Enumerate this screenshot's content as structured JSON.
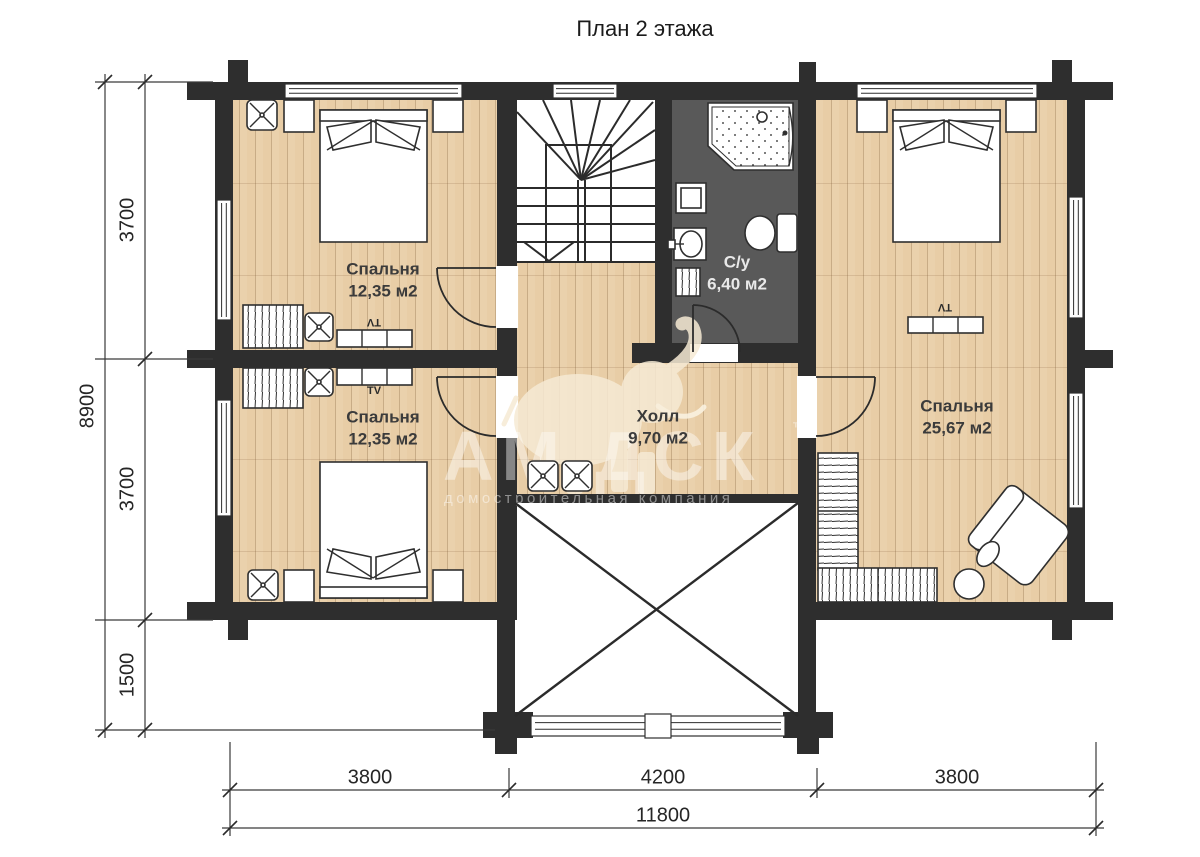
{
  "title": "План 2 этажа",
  "rooms": {
    "bedroom_top_left": {
      "name": "Спальня",
      "area": "12,35 м2"
    },
    "bedroom_bottom_left": {
      "name": "Спальня",
      "area": "12,35 м2"
    },
    "bathroom": {
      "name": "С/у",
      "area": "6,40 м2"
    },
    "hall": {
      "name": "Холл",
      "area": "9,70 м2"
    },
    "bedroom_right": {
      "name": "Спальня",
      "area": "25,67 м2"
    }
  },
  "dimensions": {
    "left": {
      "total": "8900",
      "segments": [
        "3700",
        "3700",
        "1500"
      ]
    },
    "bottom": {
      "total": "11800",
      "segments": [
        "3800",
        "4200",
        "3800"
      ]
    }
  },
  "labels": {
    "tv": "TV"
  },
  "watermark": {
    "text": "АМ ДСК",
    "tm": "™",
    "subtitle": "домостроительная компания"
  },
  "colors": {
    "wall": "#2e2e2e",
    "wood": "#e8cda6",
    "bathroom_floor": "#595959",
    "watermark": "#f6ead4"
  }
}
